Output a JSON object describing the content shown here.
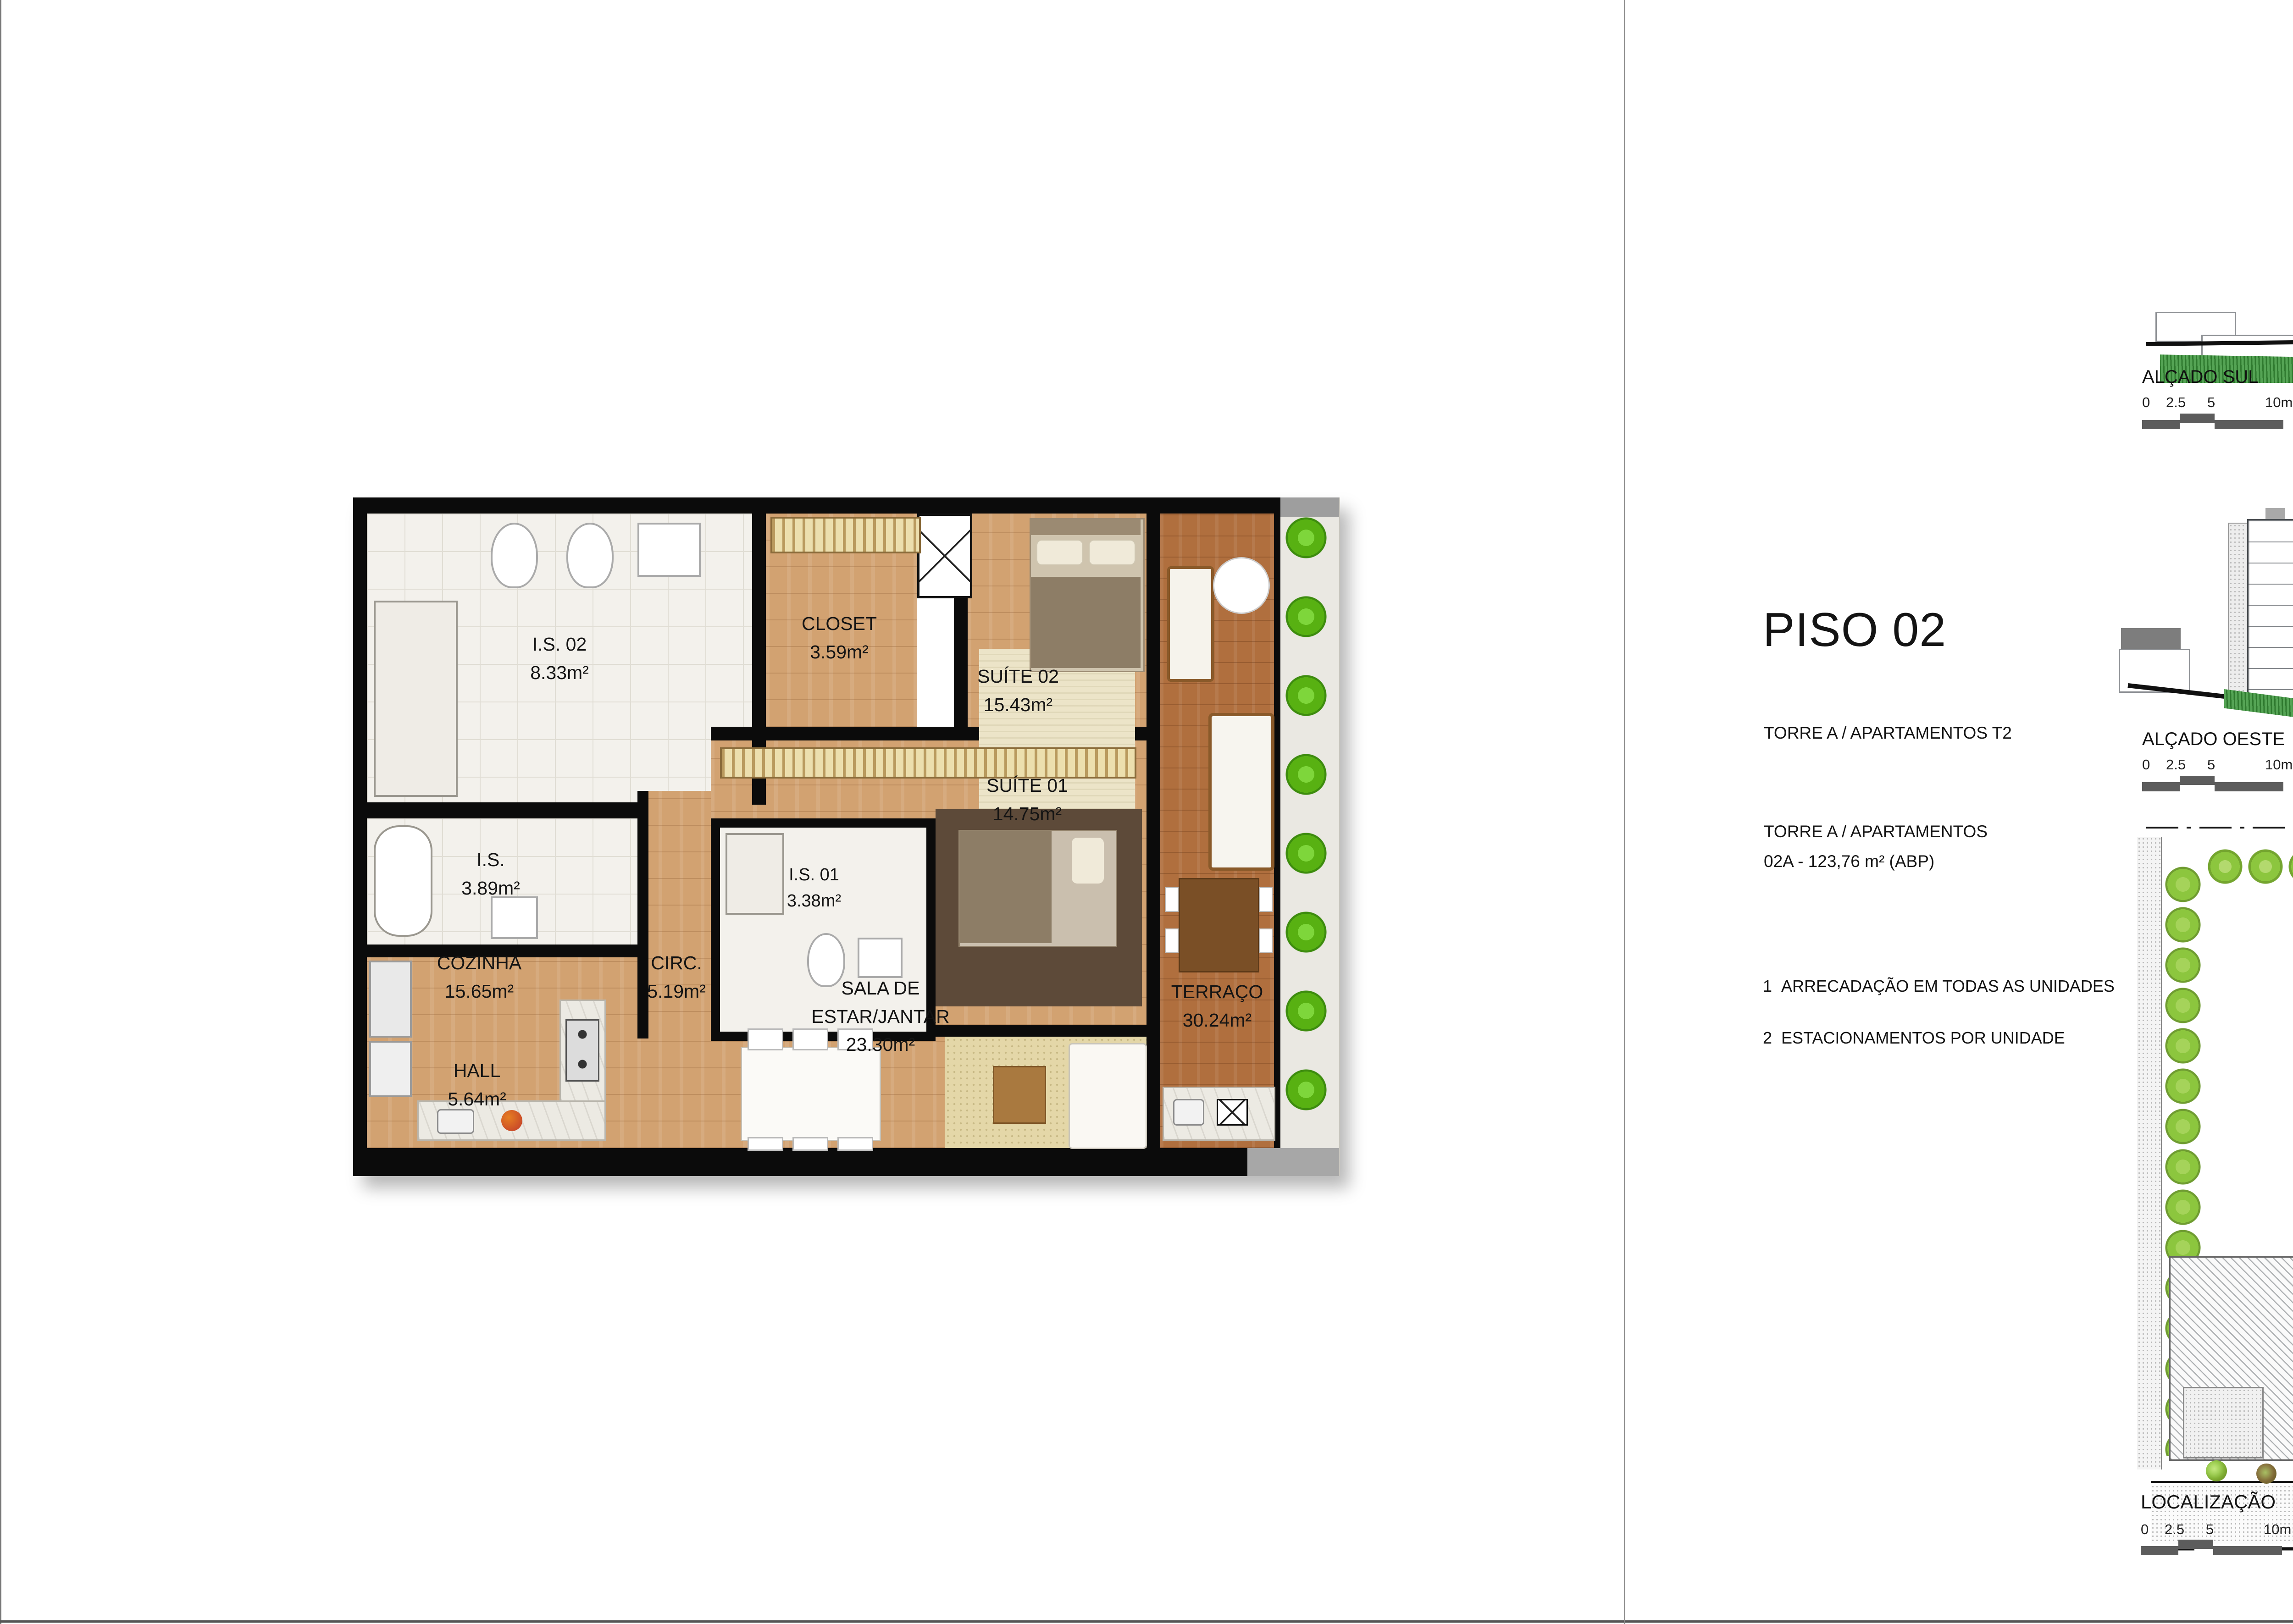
{
  "header": {
    "title": "PISO 02",
    "subtitle": "TORRE A  / APARTAMENTOS T2",
    "block_title": "TORRE A / APARTAMENTOS",
    "block_detail": "02A - 123,76 m²   (ABP)",
    "notes": [
      {
        "num": "1",
        "text": "ARRECADAÇÃO EM TODAS AS UNIDADES"
      },
      {
        "num": "2",
        "text": "ESTACIONAMENTOS POR UNIDADE"
      }
    ]
  },
  "floorplan": {
    "rooms": {
      "is02": {
        "label": "I.S. 02",
        "area": "8.33m²"
      },
      "closet": {
        "label": "CLOSET",
        "area": "3.59m²"
      },
      "suite02": {
        "label": "SUÍTE 02",
        "area": "15.43m²"
      },
      "is": {
        "label": "I.S.",
        "area": "3.89m²"
      },
      "circ": {
        "label": "CIRC.",
        "area": "5.19m²"
      },
      "suite01": {
        "label": "SUÍTE 01",
        "area": "14.75m²"
      },
      "is01": {
        "label": "I.S. 01",
        "area": "3.38m²"
      },
      "cozinha": {
        "label": "COZINHA",
        "area": "15.65m²"
      },
      "hall": {
        "label": "HALL",
        "area": "5.64m²"
      },
      "sala": {
        "label_line1": "SALA DE",
        "label_line2": "ESTAR/JANTAR",
        "area": "23.30m²"
      },
      "terraco": {
        "label": "TERRAÇO",
        "area": "30.24m²"
      }
    }
  },
  "elevation_sul": {
    "label": "ALÇADO SUL",
    "unit_tag": "02A",
    "scale_ticks": [
      "0",
      "2.5",
      "5",
      "10m"
    ]
  },
  "elevation_oeste": {
    "label": "ALÇADO OESTE",
    "scale_ticks": [
      "0",
      "2.5",
      "5",
      "10m"
    ]
  },
  "siteplan": {
    "label": "LOCALIZAÇÃO",
    "scale_ticks": [
      "0",
      "2.5",
      "5",
      "10m"
    ],
    "torre_b": {
      "label": "TORRE B",
      "core_label": "CIRCULAÇÃO/HALL",
      "core_area": "52.06m²",
      "units": [
        "02A",
        "02B",
        "02C",
        "02D"
      ]
    },
    "torre_a": {
      "label": "TORRE A",
      "units": [
        "02A",
        "02B",
        "02C",
        "02D"
      ],
      "highlighted_unit": "02A"
    },
    "marker_south": "ALÇADO SUL",
    "marker_west": "ALÇADO OESTE",
    "projection_labels": [
      "PROJEÇÃO PISO 1",
      "PROJEÇÃO PISO 2",
      "PROJEÇÃO PISO 3",
      "PROJEÇÃO PISO 4"
    ]
  },
  "colors": {
    "highlight_gray": "#8f9093",
    "pool_light": "#6fd4f2",
    "pool_dark": "#4f7f99",
    "hedge_green": "#58b112",
    "site_green": "#8cc63e",
    "wood_light": "#d2a271",
    "wood_dark": "#b06f3e"
  }
}
